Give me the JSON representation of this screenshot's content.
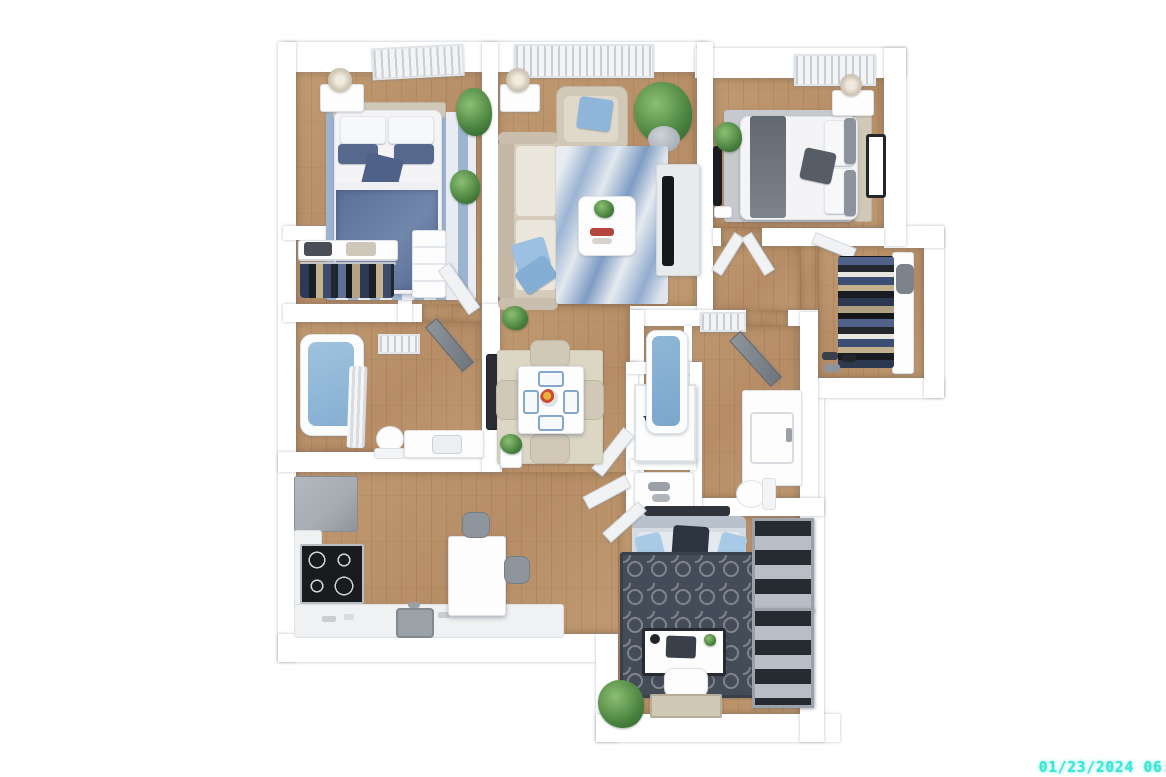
{
  "scene": {
    "kind": "3d-apartment-floor-plan-render",
    "washer_dryer_label": "W/D",
    "timestamp_text": "01/23/2024 06:"
  },
  "colors": {
    "wall": "#ffffff",
    "wall_edge": "#dfe3e8",
    "floor_wood": "#c09a71",
    "rug_bedroom1": "#9db4d0",
    "rug_bedroom2": "#c6c9cd",
    "rug_dining": "#dcd7c5",
    "rug_den_dark": "#454c59",
    "sofa_beige": "#d6ccbc",
    "pillow_blue": "#8fb6d9",
    "duvet_navy": "#5a6f96",
    "loveseat_gray_blue": "#d4dbe2",
    "tub_water": "#9fc3de",
    "appliance_gray": "#a7acb2",
    "stove_black": "#1a1b1e",
    "counter": "#eff1f2",
    "bookcase_gray": "#b7bec6",
    "timestamp_cyan": "#38e6d4",
    "text_dark": "#20242a"
  }
}
